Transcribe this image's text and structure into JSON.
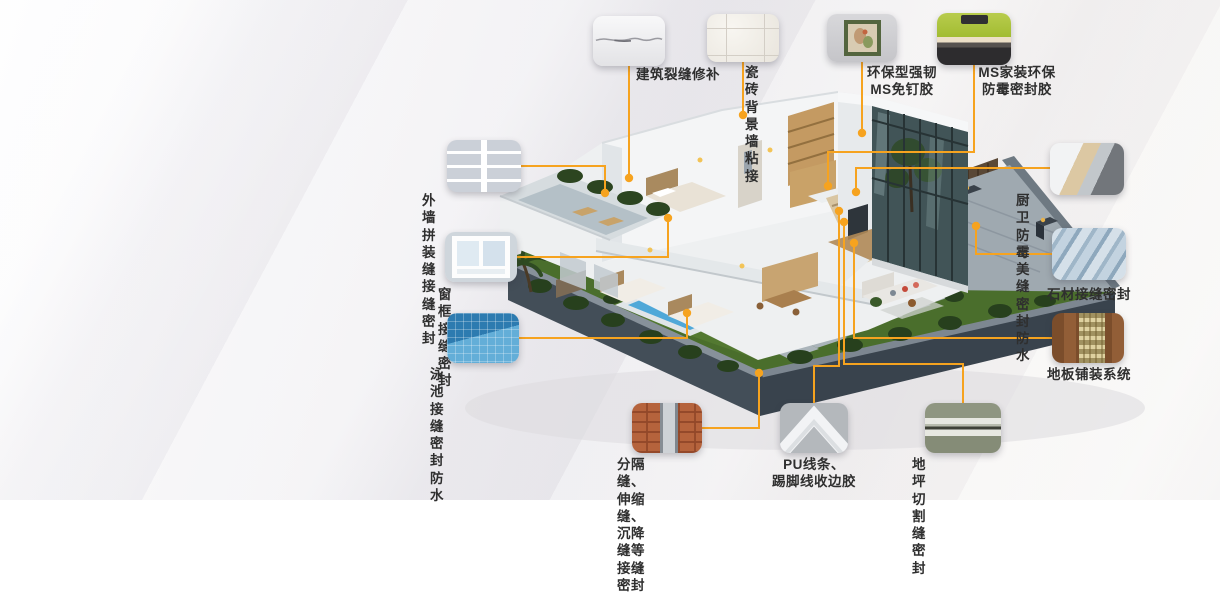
{
  "accent_color": "#F6A31F",
  "text_color": "#2F2F2F",
  "illustration": {
    "subject": "isometric cutaway villa with garden and pool",
    "pool_color": "#4FA8D8",
    "lawn_color": "#4A6E2C"
  },
  "callouts": [
    {
      "id": "crack-repair",
      "label": "建筑裂缝修补",
      "photo": "wall-crack-photo"
    },
    {
      "id": "tile-wall-bonding",
      "label": "瓷砖\n背景墙粘接",
      "photo": "tile-wall-photo"
    },
    {
      "id": "nail-free-adhesive",
      "label": "环保型强韧\nMS免钉胶",
      "photo": "framed-picture-photo"
    },
    {
      "id": "home-mildew-sealant",
      "label": "MS家装环保\n防霉密封胶",
      "photo": "kitchen-backsplash-photo"
    },
    {
      "id": "exterior-panel-joint",
      "label": "外墙拼装缝接缝密封",
      "photo": "exterior-panel-photo"
    },
    {
      "id": "window-frame-joint",
      "label": "窗框接缝密封",
      "photo": "window-frame-photo"
    },
    {
      "id": "pool-joint-waterproof",
      "label": "泳池接缝密封防水",
      "photo": "pool-mosaic-photo"
    },
    {
      "id": "kitchen-bath-joint",
      "label": "厨卫防霉美缝密封防水",
      "photo": "kitchen-counter-photo"
    },
    {
      "id": "stone-joint",
      "label": "石材接缝密封",
      "photo": "stone-steps-photo"
    },
    {
      "id": "floor-paving-system",
      "label": "地板铺装系统",
      "photo": "wood-floor-adhesive-photo"
    },
    {
      "id": "expansion-joint",
      "label": "分隔缝、伸缩缝、\n沉降缝等接缝密封",
      "photo": "brick-expansion-joint-photo"
    },
    {
      "id": "pu-trim-adhesive",
      "label": "PU线条、\n踢脚线收边胶",
      "photo": "pu-molding-photo"
    },
    {
      "id": "floor-cut-joint",
      "label": "地坪切割缝密封",
      "photo": "concrete-cut-joint-photo"
    }
  ]
}
